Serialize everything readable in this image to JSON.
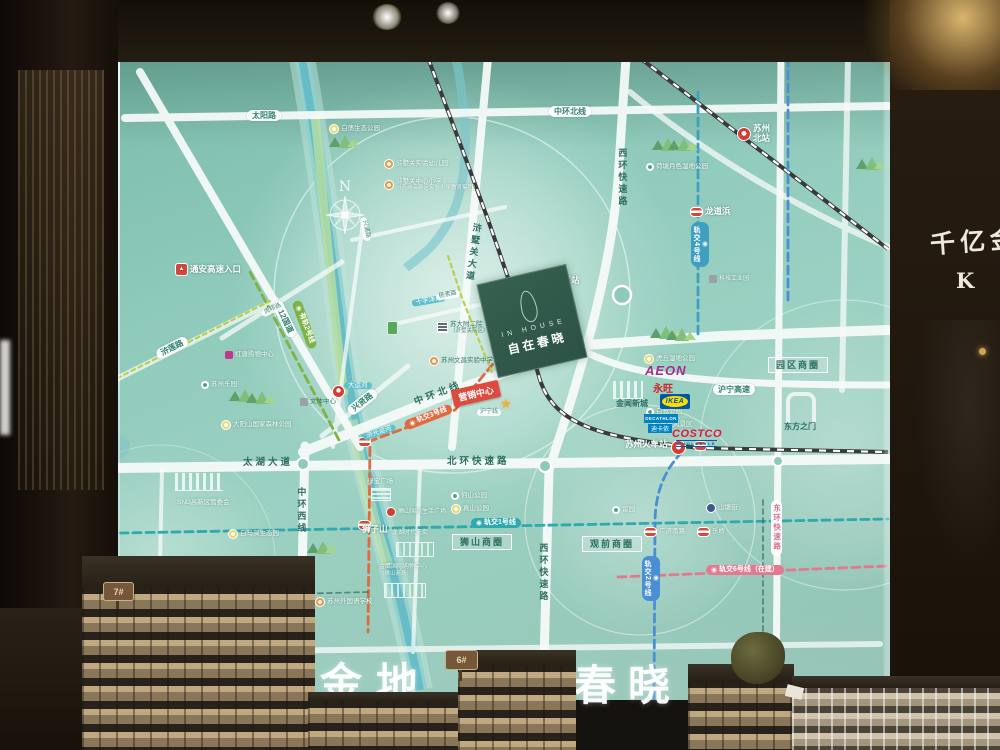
{
  "scene": {
    "description": "Showroom photo: large backlit location map board with scale models in front",
    "banner": {
      "chars": [
        "金",
        "地",
        "春",
        "晓"
      ]
    },
    "right_wall": {
      "calligraphy": "千亿金",
      "logo_letter": "K"
    },
    "model_signs": {
      "left": "7#",
      "center": "6#"
    }
  },
  "project": {
    "name_en": "IN HOUSE",
    "name_cn": "自在春晓",
    "marker": "营销中心",
    "block_color": "#2f584b"
  },
  "compass_label": "N",
  "brands": {
    "aeon_en": "AEON",
    "aeon_cn": "永旺",
    "ikea": "IKEA",
    "decathlon_en": "DECATHLON",
    "decathlon_cn": "迪卡侬",
    "costco": "COSTCO",
    "costco_sub": "WHOLESALE"
  },
  "colors": {
    "map_bg": "#8fcabb",
    "road": "#f7fbf9",
    "metro_line1": "#2fa9ad",
    "metro_line2": "#4a8fd4",
    "metro_line3": "#e06a3f",
    "metro_line4": "#3f9fc0",
    "metro_line6": "#e2798f",
    "tram_line2": "#7cb342",
    "river": "#62b9c6",
    "station_red": "#d43c34"
  },
  "map": {
    "labels": [
      {
        "n": "road-taiyanglu",
        "t": "太阳路",
        "x": 247,
        "y": 110,
        "k": "pill"
      },
      {
        "n": "road-zhonghuan-north-pill",
        "t": "中环北线",
        "x": 549,
        "y": 106,
        "k": "pill"
      },
      {
        "n": "road-312-guodao",
        "t": "312国道",
        "x": 276,
        "y": 296,
        "r": 64,
        "k": "pill"
      },
      {
        "n": "road-hulianlu",
        "t": "浒莲路",
        "x": 157,
        "y": 350,
        "r": -27,
        "k": "pill"
      },
      {
        "n": "road-huliulu",
        "t": "虎疁路",
        "x": 262,
        "y": 311,
        "r": -25,
        "k": "pill-micro"
      },
      {
        "n": "road-xingxianlu",
        "t": "兴贤路",
        "x": 349,
        "y": 407,
        "r": -38,
        "k": "pill"
      },
      {
        "n": "road-huning-expwy",
        "t": "沪宁高速",
        "x": 713,
        "y": 384,
        "k": "pill"
      },
      {
        "n": "rail-huning-line",
        "t": "沪宁线",
        "x": 477,
        "y": 409,
        "k": "pill-micro"
      },
      {
        "n": "river-dayunhe",
        "t": "大运河",
        "x": 344,
        "y": 382,
        "k": "water"
      },
      {
        "n": "river-huguang",
        "t": "浒光运河",
        "x": 363,
        "y": 434,
        "r": -18,
        "k": "water"
      },
      {
        "n": "river-shiziyang",
        "t": "十字洋河",
        "x": 412,
        "y": 300,
        "r": -10,
        "k": "water"
      },
      {
        "n": "road-yangsulu",
        "t": "杨素路",
        "x": 436,
        "y": 294,
        "r": -10,
        "k": "pill-micro"
      },
      {
        "n": "road-xingpulu",
        "t": "兴浦路",
        "x": 363,
        "y": 214,
        "r": 78,
        "k": "pill-micro"
      },
      {
        "n": "road-taihu-dadao",
        "t": "太湖大道",
        "x": 243,
        "y": 458,
        "k": "road"
      },
      {
        "n": "road-beihuan-expwy",
        "t": "北环快速路",
        "x": 447,
        "y": 457,
        "k": "road"
      },
      {
        "n": "road-zhonghuan-north",
        "t": "中环北线",
        "x": 415,
        "y": 398,
        "r": -21,
        "k": "road"
      },
      {
        "n": "road-zhonghuan-west",
        "t": "中环西线",
        "x": 296,
        "y": 487,
        "k": "road-v"
      },
      {
        "n": "road-xihuan-expwy-north",
        "t": "西环快速路",
        "x": 617,
        "y": 148,
        "k": "road-v"
      },
      {
        "n": "road-xihuan-expwy-south",
        "t": "西环快速路",
        "x": 538,
        "y": 543,
        "k": "road-v"
      },
      {
        "n": "road-xushuguan-dadao",
        "t": "浒墅关大道",
        "x": 468,
        "y": 222,
        "r": 8,
        "k": "road-v"
      },
      {
        "n": "road-donghuan-expwy",
        "t": "东环快速路",
        "x": 771,
        "y": 500,
        "k": "pill-v"
      },
      {
        "n": "metro-line1-pill",
        "t": "轨交1号线",
        "x": 471,
        "y": 518,
        "k": "m1",
        "i": "m"
      },
      {
        "n": "metro-line2-pill",
        "t": "轨交2号线",
        "x": 642,
        "y": 556,
        "k": "m2v",
        "i": "m"
      },
      {
        "n": "metro-line3-pill",
        "t": "轨交3号线",
        "x": 405,
        "y": 421,
        "r": -21,
        "k": "m3",
        "i": "m"
      },
      {
        "n": "metro-line4-pill",
        "t": "轨交4号线",
        "x": 691,
        "y": 222,
        "k": "m4v",
        "i": "m"
      },
      {
        "n": "metro-line6-pill",
        "t": "轨交6号线（在建）",
        "x": 706,
        "y": 565,
        "k": "m6",
        "i": "m"
      },
      {
        "n": "tram-line2-pill",
        "t": "有轨2号线",
        "x": 296,
        "y": 296,
        "r": 70,
        "k": "tram",
        "i": "m"
      },
      {
        "n": "biz-circle-shishan",
        "t": "狮山商圈",
        "x": 452,
        "y": 534,
        "k": "box"
      },
      {
        "n": "biz-circle-guanqian",
        "t": "观前商圈",
        "x": 582,
        "y": 536,
        "k": "box"
      },
      {
        "n": "biz-circle-yuanqu",
        "t": "园区商圈",
        "x": 768,
        "y": 357,
        "k": "box"
      },
      {
        "n": "station-suzhou-xinqu",
        "t": "苏州新区站",
        "x": 521,
        "y": 274,
        "k": "white",
        "i": "rail"
      },
      {
        "n": "station-suzhou-north",
        "t": "苏州北站",
        "x": 737,
        "y": 124,
        "k": "white2",
        "i": "rail"
      },
      {
        "n": "station-longdaobang",
        "t": "龙道浜",
        "x": 690,
        "y": 207,
        "k": "white",
        "i": "metro"
      },
      {
        "n": "station-suzhou-railway",
        "t": "苏州火车站",
        "x": 625,
        "y": 440,
        "k": "white"
      },
      {
        "n": "station-mudu",
        "t": "木渎",
        "x": 225,
        "y": 588,
        "k": "white",
        "i": "metro"
      },
      {
        "n": "station-guangji-south-rd",
        "t": "广济南路",
        "x": 644,
        "y": 527,
        "k": "white-sm",
        "i": "metro"
      },
      {
        "n": "station-leqiao",
        "t": "乐桥",
        "x": 697,
        "y": 527,
        "k": "white-sm",
        "i": "metro"
      },
      {
        "n": "poi-shantangjie",
        "t": "山塘街",
        "x": 706,
        "y": 503,
        "k": "white-sm",
        "i": "sqB"
      },
      {
        "n": "poi-liuyuan",
        "t": "留园",
        "x": 612,
        "y": 506,
        "k": "white-sm",
        "i": "dotW"
      },
      {
        "n": "poi-jinchang-newtown",
        "t": "金阊新城",
        "x": 616,
        "y": 399,
        "k": "dark"
      },
      {
        "n": "poi-gate-of-orient",
        "t": "东方之门",
        "x": 784,
        "y": 422,
        "k": "dark"
      },
      {
        "n": "poi-bailu-park",
        "t": "白鹭公园",
        "x": 646,
        "y": 408,
        "k": "white-sm",
        "i": "dotW"
      },
      {
        "n": "poi-huqiu-scenic",
        "t": "虎丘风景区",
        "x": 650,
        "y": 420,
        "k": "white-sm",
        "i": "pagoda"
      },
      {
        "n": "poi-huqiu-wetland-park",
        "t": "虎丘湿地公园",
        "x": 644,
        "y": 354,
        "k": "white-sm",
        "i": "dotY"
      },
      {
        "n": "poi-hetangyuese-wetland-park",
        "t": "荷塘月色湿地公园",
        "x": 646,
        "y": 163,
        "k": "white-sm",
        "i": "dotW"
      },
      {
        "n": "poi-baidang-eco-park",
        "t": "白荡生态公园",
        "x": 329,
        "y": 124,
        "k": "white-sm",
        "i": "dotY"
      },
      {
        "n": "poi-culture-sports-center",
        "t": "文体中心",
        "x": 300,
        "y": 398,
        "k": "dark-sm",
        "i": "sqG"
      },
      {
        "n": "poi-snd-committee",
        "t": "SND高新区管委会",
        "x": 177,
        "y": 499,
        "k": "white-sm"
      },
      {
        "n": "poi-baimajian-eco-park",
        "t": "白马涧生态园",
        "x": 228,
        "y": 529,
        "k": "white-sm",
        "i": "dotY"
      },
      {
        "n": "poi-shizishan",
        "t": "狮子山",
        "x": 362,
        "y": 525,
        "k": "white"
      },
      {
        "n": "poi-lvbao-plaza",
        "t": "绿宝广场",
        "x": 367,
        "y": 478,
        "k": "white-sm"
      },
      {
        "n": "poi-shishan-intl-life-plaza",
        "t": "狮山国际生活广场",
        "x": 386,
        "y": 507,
        "k": "tiny",
        "i": "sqRed"
      },
      {
        "n": "poi-longfor-paradise-walk",
        "t": "龙湖时代天街",
        "x": 392,
        "y": 530,
        "k": "tiny"
      },
      {
        "n": "poi-jinying-mall",
        "t": "金鹰国际购物中心",
        "s": "（狮山商场）",
        "x": 379,
        "y": 564,
        "k": "tiny"
      },
      {
        "n": "poi-heshan-park",
        "t": "何山公园",
        "x": 451,
        "y": 492,
        "k": "white-sm",
        "i": "dotW"
      },
      {
        "n": "poi-zhenshan-park",
        "t": "真山公园",
        "x": 451,
        "y": 504,
        "k": "white-sm",
        "i": "dotY"
      },
      {
        "n": "poi-suzhou-foreign-language-school",
        "t": "苏州外国语学校",
        "x": 315,
        "y": 597,
        "k": "white-sm",
        "i": "dotO"
      },
      {
        "n": "poi-suzhou-amusement-land",
        "t": "苏州乐园",
        "x": 201,
        "y": 381,
        "k": "white-sm",
        "i": "dotW"
      },
      {
        "n": "poi-dayangshan-forest-park",
        "t": "大阳山国家森林公园",
        "x": 221,
        "y": 420,
        "k": "white-sm",
        "i": "dotY"
      },
      {
        "n": "poi-hongtang-mall",
        "t": "红唐购物中心",
        "x": 225,
        "y": 351,
        "k": "white-sm",
        "i": "sqM"
      },
      {
        "n": "poi-tongan-expwy-entrance",
        "t": "通安高速入口",
        "x": 175,
        "y": 263,
        "k": "white",
        "i": "hw"
      },
      {
        "n": "poi-suda-fuer-hospital",
        "t": "苏大附二院",
        "s": "（浒墅关院区）",
        "x": 437,
        "y": 321,
        "k": "dark-sm",
        "i": "bldg"
      },
      {
        "n": "poi-wenchang-middle-school",
        "t": "苏州文昌实验中学",
        "x": 429,
        "y": 356,
        "k": "dark-sm",
        "i": "dotO"
      },
      {
        "n": "poi-xushuguan-kindergarten",
        "t": "浒墅关实验幼儿园",
        "x": 384,
        "y": 159,
        "k": "white-sm",
        "i": "dotO"
      },
      {
        "n": "poi-xushuguan-primary-school",
        "t": "浒墅关中心小学",
        "s": "（苏州高新区实验小学教育集团）",
        "x": 384,
        "y": 178,
        "k": "white-sm",
        "i": "dotO"
      },
      {
        "n": "poi-tech-industrial-park",
        "t": "科技工业园",
        "x": 709,
        "y": 275,
        "k": "tiny",
        "i": "sqG"
      }
    ],
    "icons": [
      {
        "k": "gate",
        "x": 786,
        "y": 392,
        "n": "gate-of-orient-icon"
      },
      {
        "k": "skyline",
        "x": 613,
        "y": 381,
        "w": 30,
        "n": "jinchang-skyline-icon"
      },
      {
        "k": "skyline",
        "x": 175,
        "y": 473,
        "w": 48,
        "n": "snd-skyline-icon"
      },
      {
        "k": "malllines",
        "x": 396,
        "y": 542,
        "w": 36,
        "n": "longfor-mall-icon"
      },
      {
        "k": "malllines",
        "x": 384,
        "y": 583,
        "w": 40,
        "n": "jinying-mall-icon"
      },
      {
        "k": "mallsm",
        "x": 371,
        "y": 488,
        "n": "lvbao-mall-icon"
      },
      {
        "k": "greenplaza",
        "x": 530,
        "y": 285,
        "n": "green-plaza-icon"
      },
      {
        "k": "redpoi",
        "x": 332,
        "y": 385,
        "n": "canal-poi-icon"
      },
      {
        "k": "towergreen",
        "x": 387,
        "y": 321,
        "n": "sales-tower-icon"
      },
      {
        "k": "railic",
        "x": 671,
        "y": 440,
        "n": "suzhou-railway-station-icon"
      },
      {
        "k": "metroic",
        "x": 694,
        "y": 441,
        "n": "metro-station-icon"
      },
      {
        "k": "metroic",
        "x": 358,
        "y": 437,
        "n": "metro-station-icon"
      },
      {
        "k": "metroic",
        "x": 358,
        "y": 520,
        "n": "metro-station-icon"
      }
    ]
  }
}
